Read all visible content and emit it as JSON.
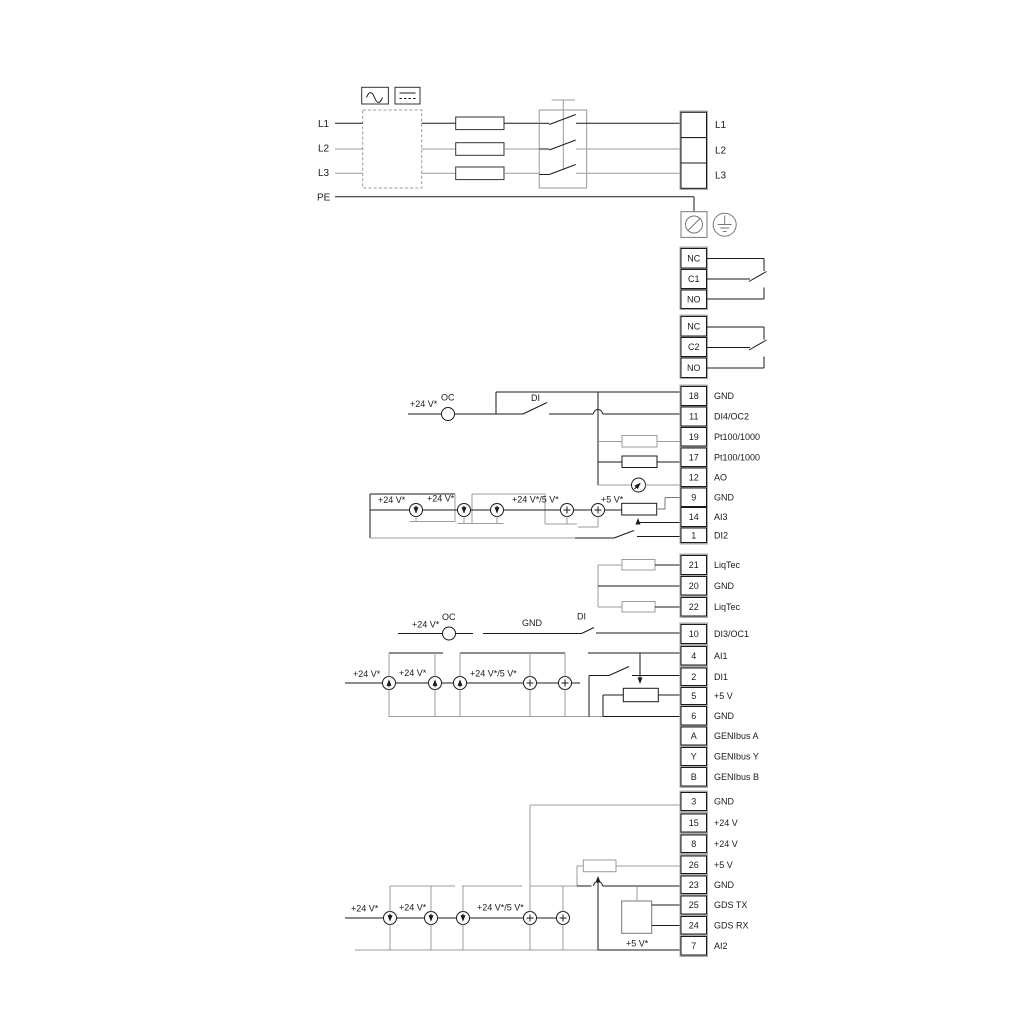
{
  "strips": {
    "mains_left": [
      "L1",
      "L2",
      "L3",
      "PE"
    ],
    "mains_right": [
      "L1",
      "L2",
      "L3"
    ],
    "relay1": [
      "NC",
      "C1",
      "NO"
    ],
    "relay2": [
      "NC",
      "C2",
      "NO"
    ],
    "strip1": [
      {
        "num": "18",
        "label": "GND"
      },
      {
        "num": "11",
        "label": "DI4/OC2"
      },
      {
        "num": "19",
        "label": "Pt100/1000"
      },
      {
        "num": "17",
        "label": "Pt100/1000"
      },
      {
        "num": "12",
        "label": "AO"
      },
      {
        "num": "9",
        "label": "GND"
      },
      {
        "num": "14",
        "label": "AI3"
      },
      {
        "num": "1",
        "label": "DI2"
      }
    ],
    "liqtec": [
      {
        "num": "21",
        "label": "LiqTec"
      },
      {
        "num": "20",
        "label": "GND"
      },
      {
        "num": "22",
        "label": "LiqTec"
      }
    ],
    "strip2": [
      {
        "num": "10",
        "label": "DI3/OC1"
      },
      {
        "num": "4",
        "label": "AI1"
      },
      {
        "num": "2",
        "label": "DI1"
      },
      {
        "num": "5",
        "label": "+5 V"
      },
      {
        "num": "6",
        "label": "GND"
      },
      {
        "num": "A",
        "label": "GENIbus A"
      },
      {
        "num": "Y",
        "label": "GENIbus Y"
      },
      {
        "num": "B",
        "label": "GENIbus B"
      }
    ],
    "strip3": [
      {
        "num": "3",
        "label": "GND"
      },
      {
        "num": "15",
        "label": "+24 V"
      },
      {
        "num": "8",
        "label": "+24 V"
      },
      {
        "num": "26",
        "label": "+5 V"
      },
      {
        "num": "23",
        "label": "GND"
      },
      {
        "num": "25",
        "label": "GDS TX"
      },
      {
        "num": "24",
        "label": "GDS RX"
      },
      {
        "num": "7",
        "label": "AI2"
      }
    ]
  },
  "annotations": {
    "di4": {
      "v24": "+24 V*",
      "oc": "OC",
      "di": "DI"
    },
    "ai3": {
      "v24a": "+24 V*",
      "v24b": "+24 V*",
      "v24_5": "+24 V*/5 V*",
      "v5": "+5 V*"
    },
    "di3": {
      "v24": "+24 V*",
      "oc": "OC",
      "gnd": "GND",
      "di": "DI"
    },
    "ai1": {
      "v24a": "+24 V*",
      "v24b": "+24 V*",
      "v24_5": "+24 V*/5 V*"
    },
    "ai2": {
      "v24a": "+24 V*",
      "v24b": "+24 V*",
      "v24_5": "+24 V*/5 V*",
      "v5": "+5 V*"
    }
  }
}
